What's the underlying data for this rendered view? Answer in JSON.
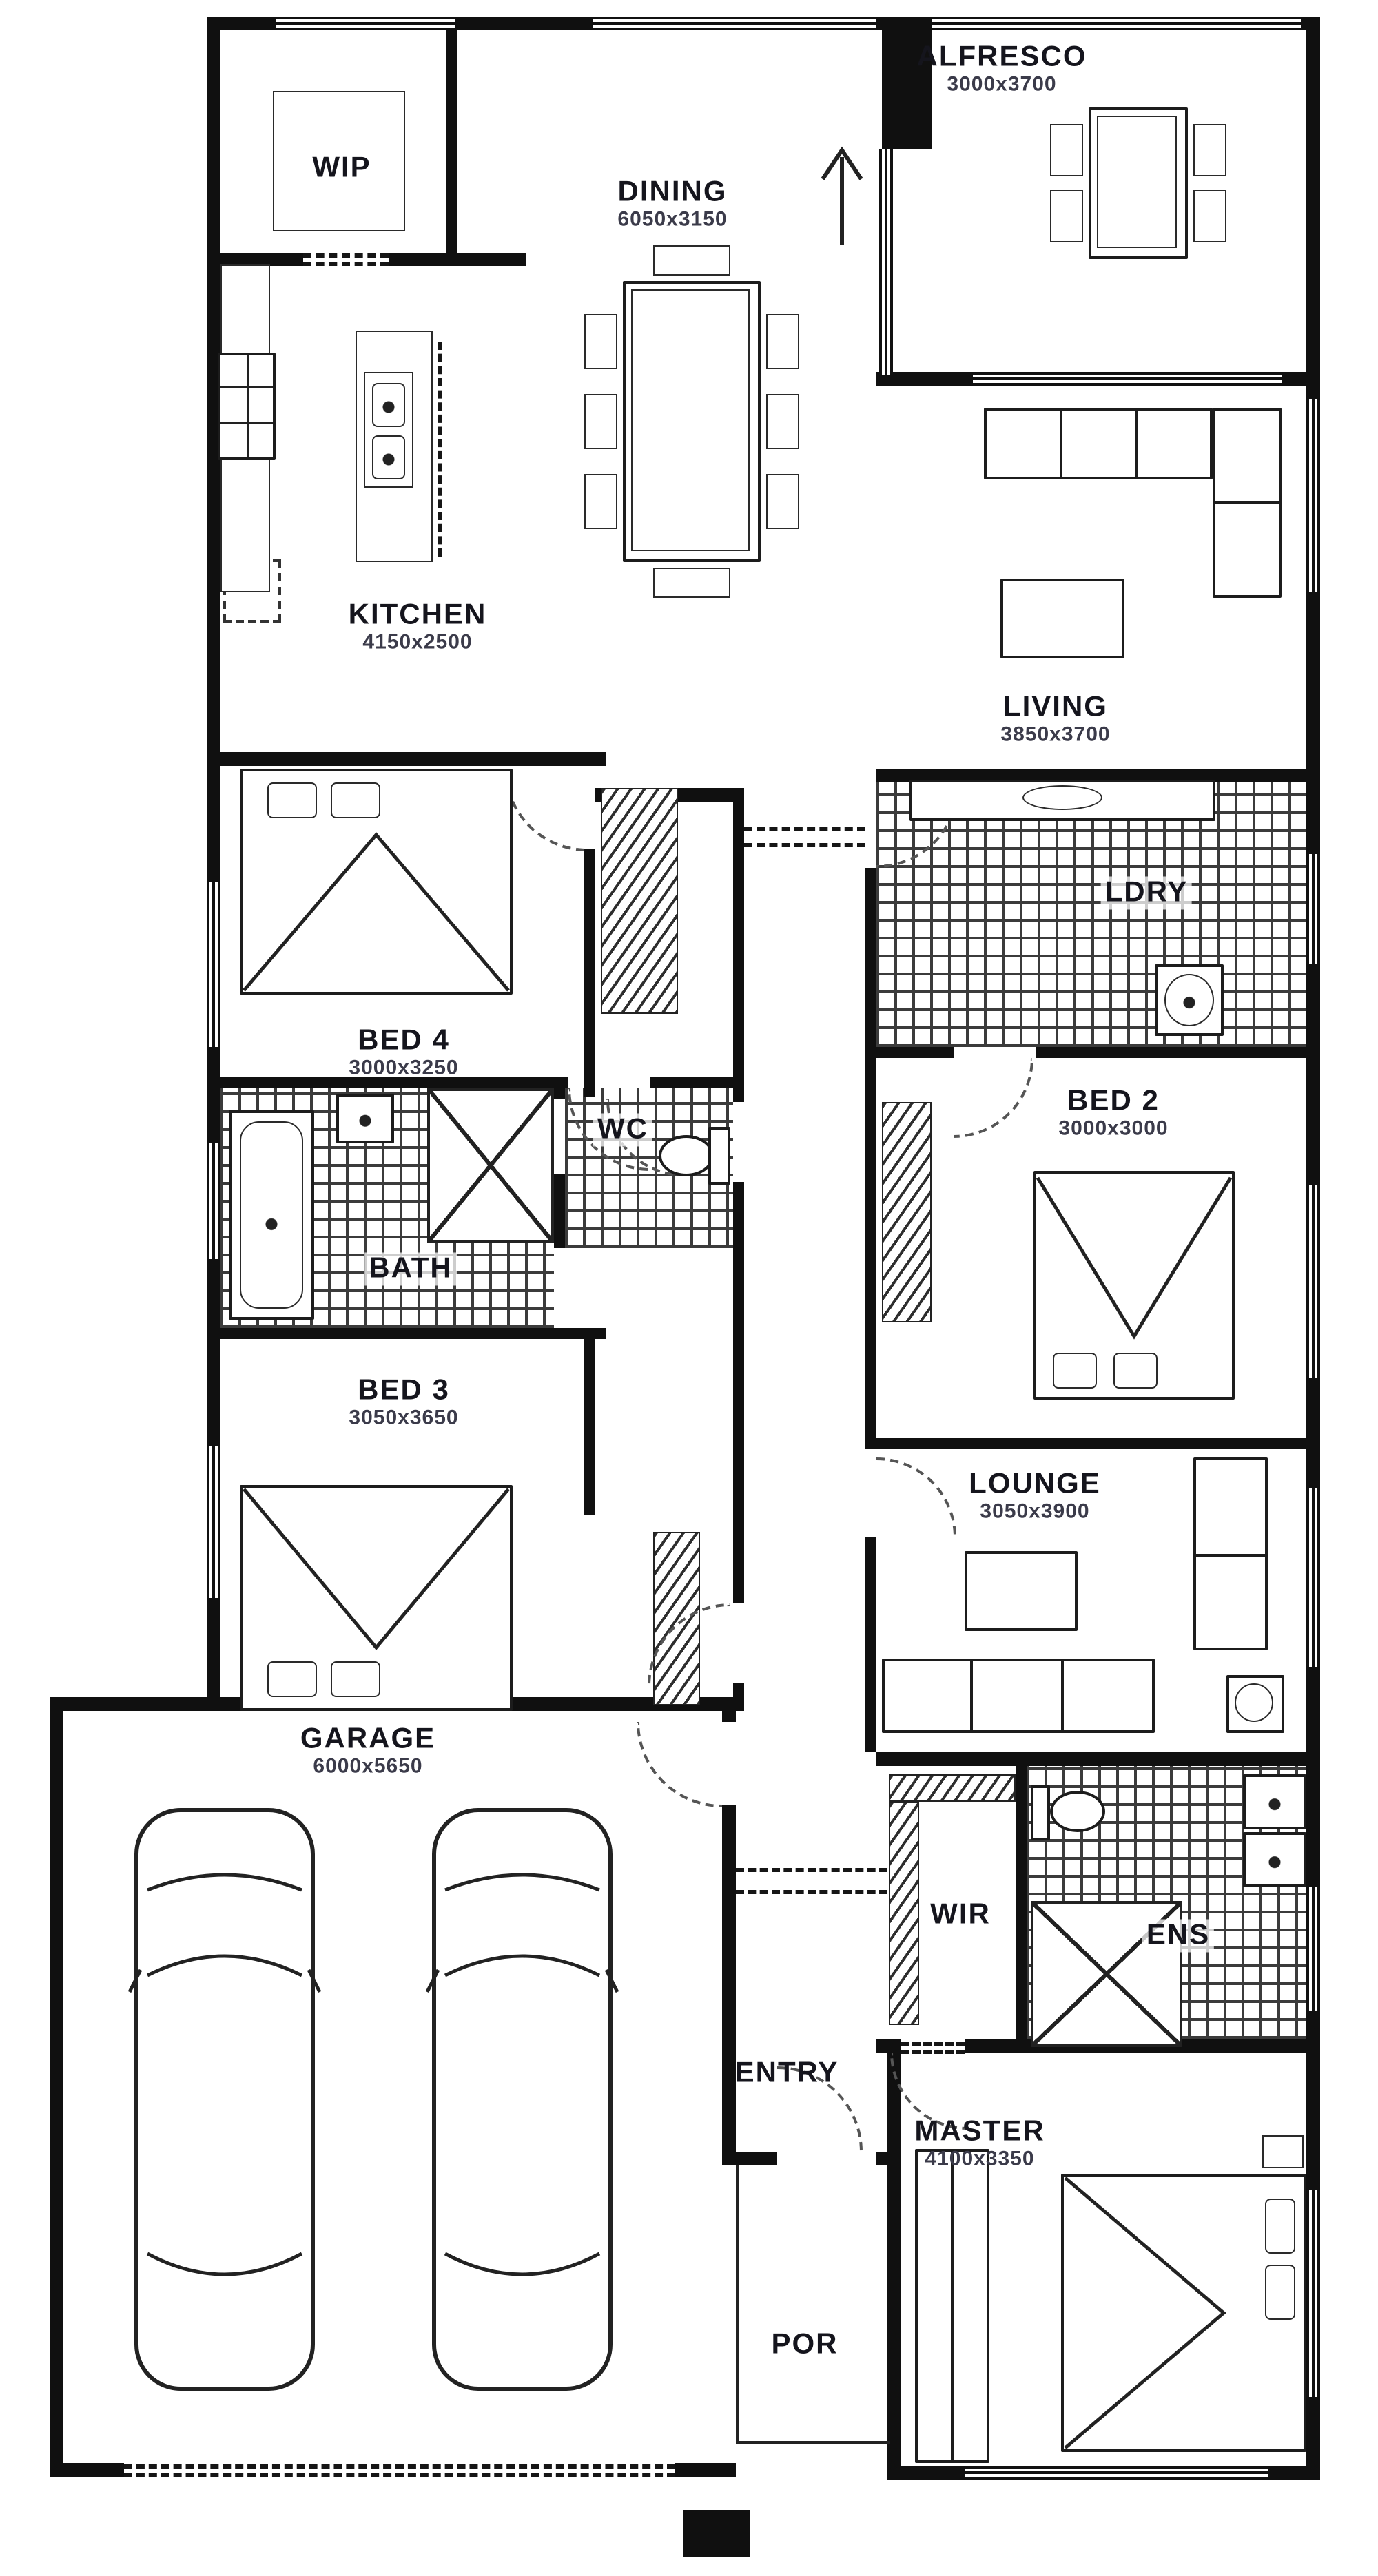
{
  "rooms": {
    "alfresco": {
      "name": "ALFRESCO",
      "dims": "3000x3700"
    },
    "wip": {
      "name": "WIP"
    },
    "dining": {
      "name": "DINING",
      "dims": "6050x3150"
    },
    "kitchen": {
      "name": "KITCHEN",
      "dims": "4150x2500"
    },
    "living": {
      "name": "LIVING",
      "dims": "3850x3700"
    },
    "bed4": {
      "name": "BED 4",
      "dims": "3000x3250"
    },
    "ldry": {
      "name": "LDRY"
    },
    "bed2": {
      "name": "BED 2",
      "dims": "3000x3000"
    },
    "wc": {
      "name": "WC"
    },
    "bath": {
      "name": "BATH"
    },
    "bed3": {
      "name": "BED 3",
      "dims": "3050x3650"
    },
    "lounge": {
      "name": "LOUNGE",
      "dims": "3050x3900"
    },
    "garage": {
      "name": "GARAGE",
      "dims": "6000x5650"
    },
    "wir": {
      "name": "WIR"
    },
    "ens": {
      "name": "ENS"
    },
    "entry": {
      "name": "ENTRY"
    },
    "master": {
      "name": "MASTER",
      "dims": "4100x3350"
    },
    "por": {
      "name": "POR"
    }
  },
  "colors": {
    "wall": "#101010",
    "tile_line": "#3b3b3b",
    "paper": "#ffffff"
  }
}
